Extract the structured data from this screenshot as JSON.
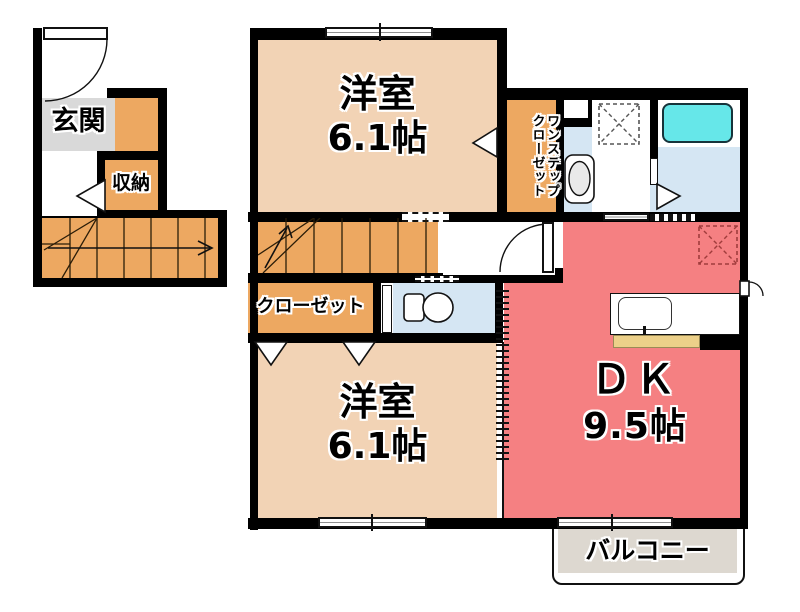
{
  "plan": {
    "entrance": {
      "label": "玄関"
    },
    "storage": {
      "label": "収納"
    },
    "room_upper": {
      "label": "洋室",
      "size": "6.1帖"
    },
    "one_step_closet": {
      "line1": "ワンステップ",
      "line2": "クローゼット"
    },
    "closet": {
      "label": "クローゼット"
    },
    "room_lower": {
      "label": "洋室",
      "size": "6.1帖"
    },
    "dk": {
      "label": "ＤＫ",
      "size": "9.5帖"
    },
    "balcony": {
      "label": "バルコニー"
    },
    "colors": {
      "wall": "#000000",
      "room_peach": "#f2d3b5",
      "closet_orange": "#eda861",
      "dk_red": "#f58082",
      "wet_blue": "#d5e6f3",
      "tub_cyan": "#66e7e9",
      "entrance_gray": "#d9d9d9",
      "balcony_gray": "#ddd8d0",
      "counter_yellow": "#ecd089"
    }
  }
}
